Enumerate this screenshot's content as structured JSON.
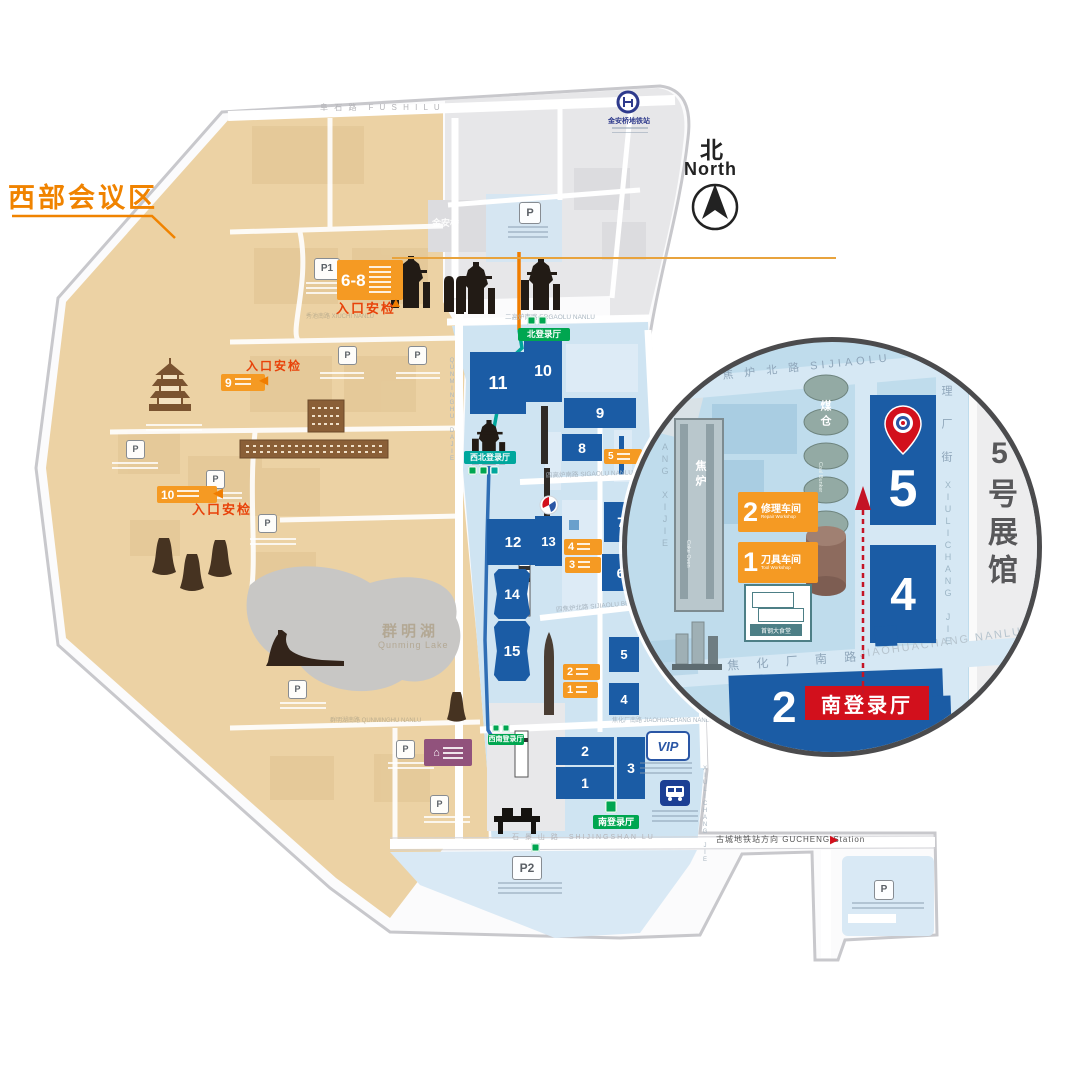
{
  "legend": {
    "west_conference": "西部会议区"
  },
  "compass": {
    "zh": "北",
    "en": "North"
  },
  "metro": {
    "jinanqiao": "金安桥地铁站",
    "gucheng": "古城地铁站方向 GUCHENG Station"
  },
  "landmark": {
    "jinanqiao_block": "金安桥"
  },
  "roads": {
    "fushi": "阜 石 路　F U S H I  L U",
    "ergaolu": "二高炉南路 ERGAOLU NANLU",
    "xiuchi": "秀池南路 XIUCHI NANLU",
    "sigaolu": "四高炉南路 SIGAOLU NANLU",
    "sijiaolu": "四焦炉北路 SIJIAOLU BEILU",
    "jiaohuachang": "焦化厂南路 JIAOHUACHANG NANLU",
    "shijingshan": "石 景 山 路　SHIJINGSHAN LU",
    "qunminghu_nanlu": "群明湖南路 QUNMINGHU NANLU",
    "qunminghu_dajie": "QUNMINGHU DAJIE",
    "xiulichang_jie": "XIULICHANG JIE"
  },
  "lake": {
    "zh": "群明湖",
    "en": "Qunming Lake"
  },
  "security_check": "入口安检",
  "gates": {
    "west": "6-8",
    "g9": "9",
    "g10": "10"
  },
  "entries": {
    "north": "北登录厅",
    "northwest": "西北登录厅",
    "southwest": "西南登录厅",
    "south": "南登录厅"
  },
  "halls": {
    "1": "1",
    "2": "2",
    "3": "3",
    "4": "4",
    "5": "5",
    "6": "6",
    "7": "7",
    "8": "8",
    "9": "9",
    "10": "10",
    "11": "11",
    "12": "12",
    "13": "13",
    "14": "14",
    "15": "15"
  },
  "workshops": {
    "w5": "5",
    "w4": "4",
    "w3": "3",
    "w2": {
      "num": "2",
      "zh": "修理车间",
      "en": "Repair Workshop"
    },
    "w1": {
      "num": "1",
      "zh": "刀具车间",
      "en": "Tool Workshop"
    }
  },
  "parking": {
    "p": "P",
    "p1": "P1",
    "p2": "P2"
  },
  "vip": "VIP",
  "skywalk": {
    "zh": "高线公园",
    "en": "Skywalk"
  },
  "inset": {
    "hall5": "5",
    "hall4": "4",
    "hall2": "2",
    "hall5_name": "5号展馆",
    "south_entry": "南登录厅",
    "coal_bunker_zh": "煤仓",
    "coal_bunker_en": "Coal Bunker",
    "coke_oven_zh": "焦炉",
    "coke_oven_en": "Coke Oven",
    "canteen": "首钢大食堂",
    "road_top": "焦 炉 北 路 SIJIAOLU",
    "street_right_zh": "理 厂 街",
    "street_right_en": "XIULICHANG JIE",
    "road_bottom_zh": "焦 化 厂 南 路",
    "road_bottom_en": "JIAOHUACHANG NANLU",
    "street_left": "ANG XIJIE"
  },
  "icons": {
    "house": "⌂",
    "arrow_left": "◀",
    "arrow_right": "▶",
    "arrow_up": "▲"
  },
  "colors": {
    "hall_blue": "#1b5ca5",
    "badge_orange": "#f59a23",
    "entry_green": "#00a650",
    "route_teal": "#00a59b",
    "route_orange": "#f07d00",
    "accent_red": "#d2101c",
    "map_beige": "#ecd2a4",
    "map_blue": "#cfe4f2"
  }
}
